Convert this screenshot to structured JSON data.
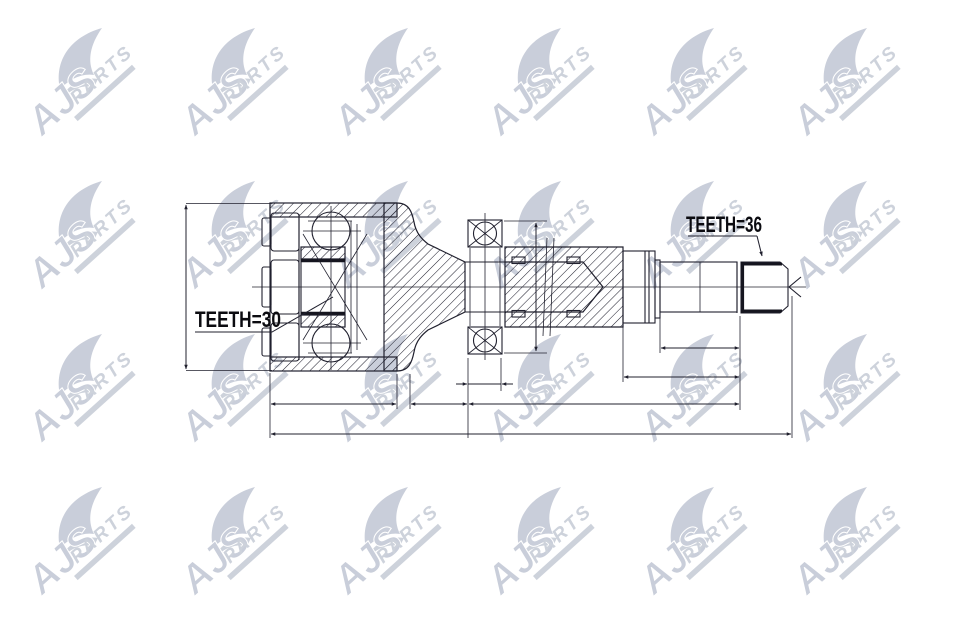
{
  "page": {
    "background": "#ffffff",
    "description": "Technical cross-section drawing of a constant-velocity drive joint with splined shaft"
  },
  "watermark": {
    "brand": "AJS",
    "suffix": "PARTS",
    "color": "#c7ccd8",
    "color_light": "#cbd0da"
  },
  "drawing": {
    "line_color": "#20202e",
    "text_color": "#0b0b10",
    "labels": {
      "teeth_inner": "TEETH=30",
      "teeth_outer": "TEETH=36"
    }
  }
}
